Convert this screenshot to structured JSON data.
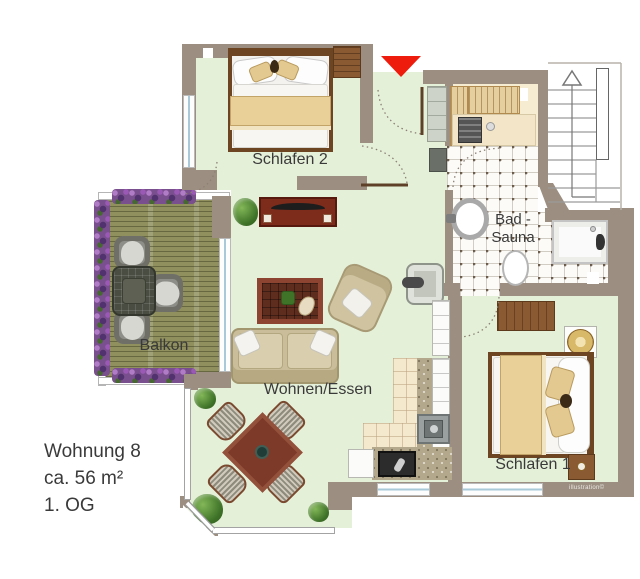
{
  "plan": {
    "rooms": [
      {
        "id": "schlafen2",
        "label": "Schlafen 2"
      },
      {
        "id": "bad_sauna",
        "label": "Bad -",
        "label2": "Sauna"
      },
      {
        "id": "balkon",
        "label": "Balkon"
      },
      {
        "id": "wohnen_essen",
        "label": "Wohnen/Essen"
      },
      {
        "id": "schlafen1",
        "label": "Schlafen 1"
      }
    ],
    "info": {
      "title": "Wohnung 8",
      "area": "ca. 56 m²",
      "floor": "1. OG"
    },
    "watermark": "illustration©",
    "colors": {
      "wall": "#9c8f81",
      "floor_green": "#e5f0d9",
      "entrance_arrow_red": "#ee1c0c",
      "deck": "#8f905e",
      "wood_furniture": "#8a5a33",
      "counter_beige": "#f4e8cd"
    }
  }
}
